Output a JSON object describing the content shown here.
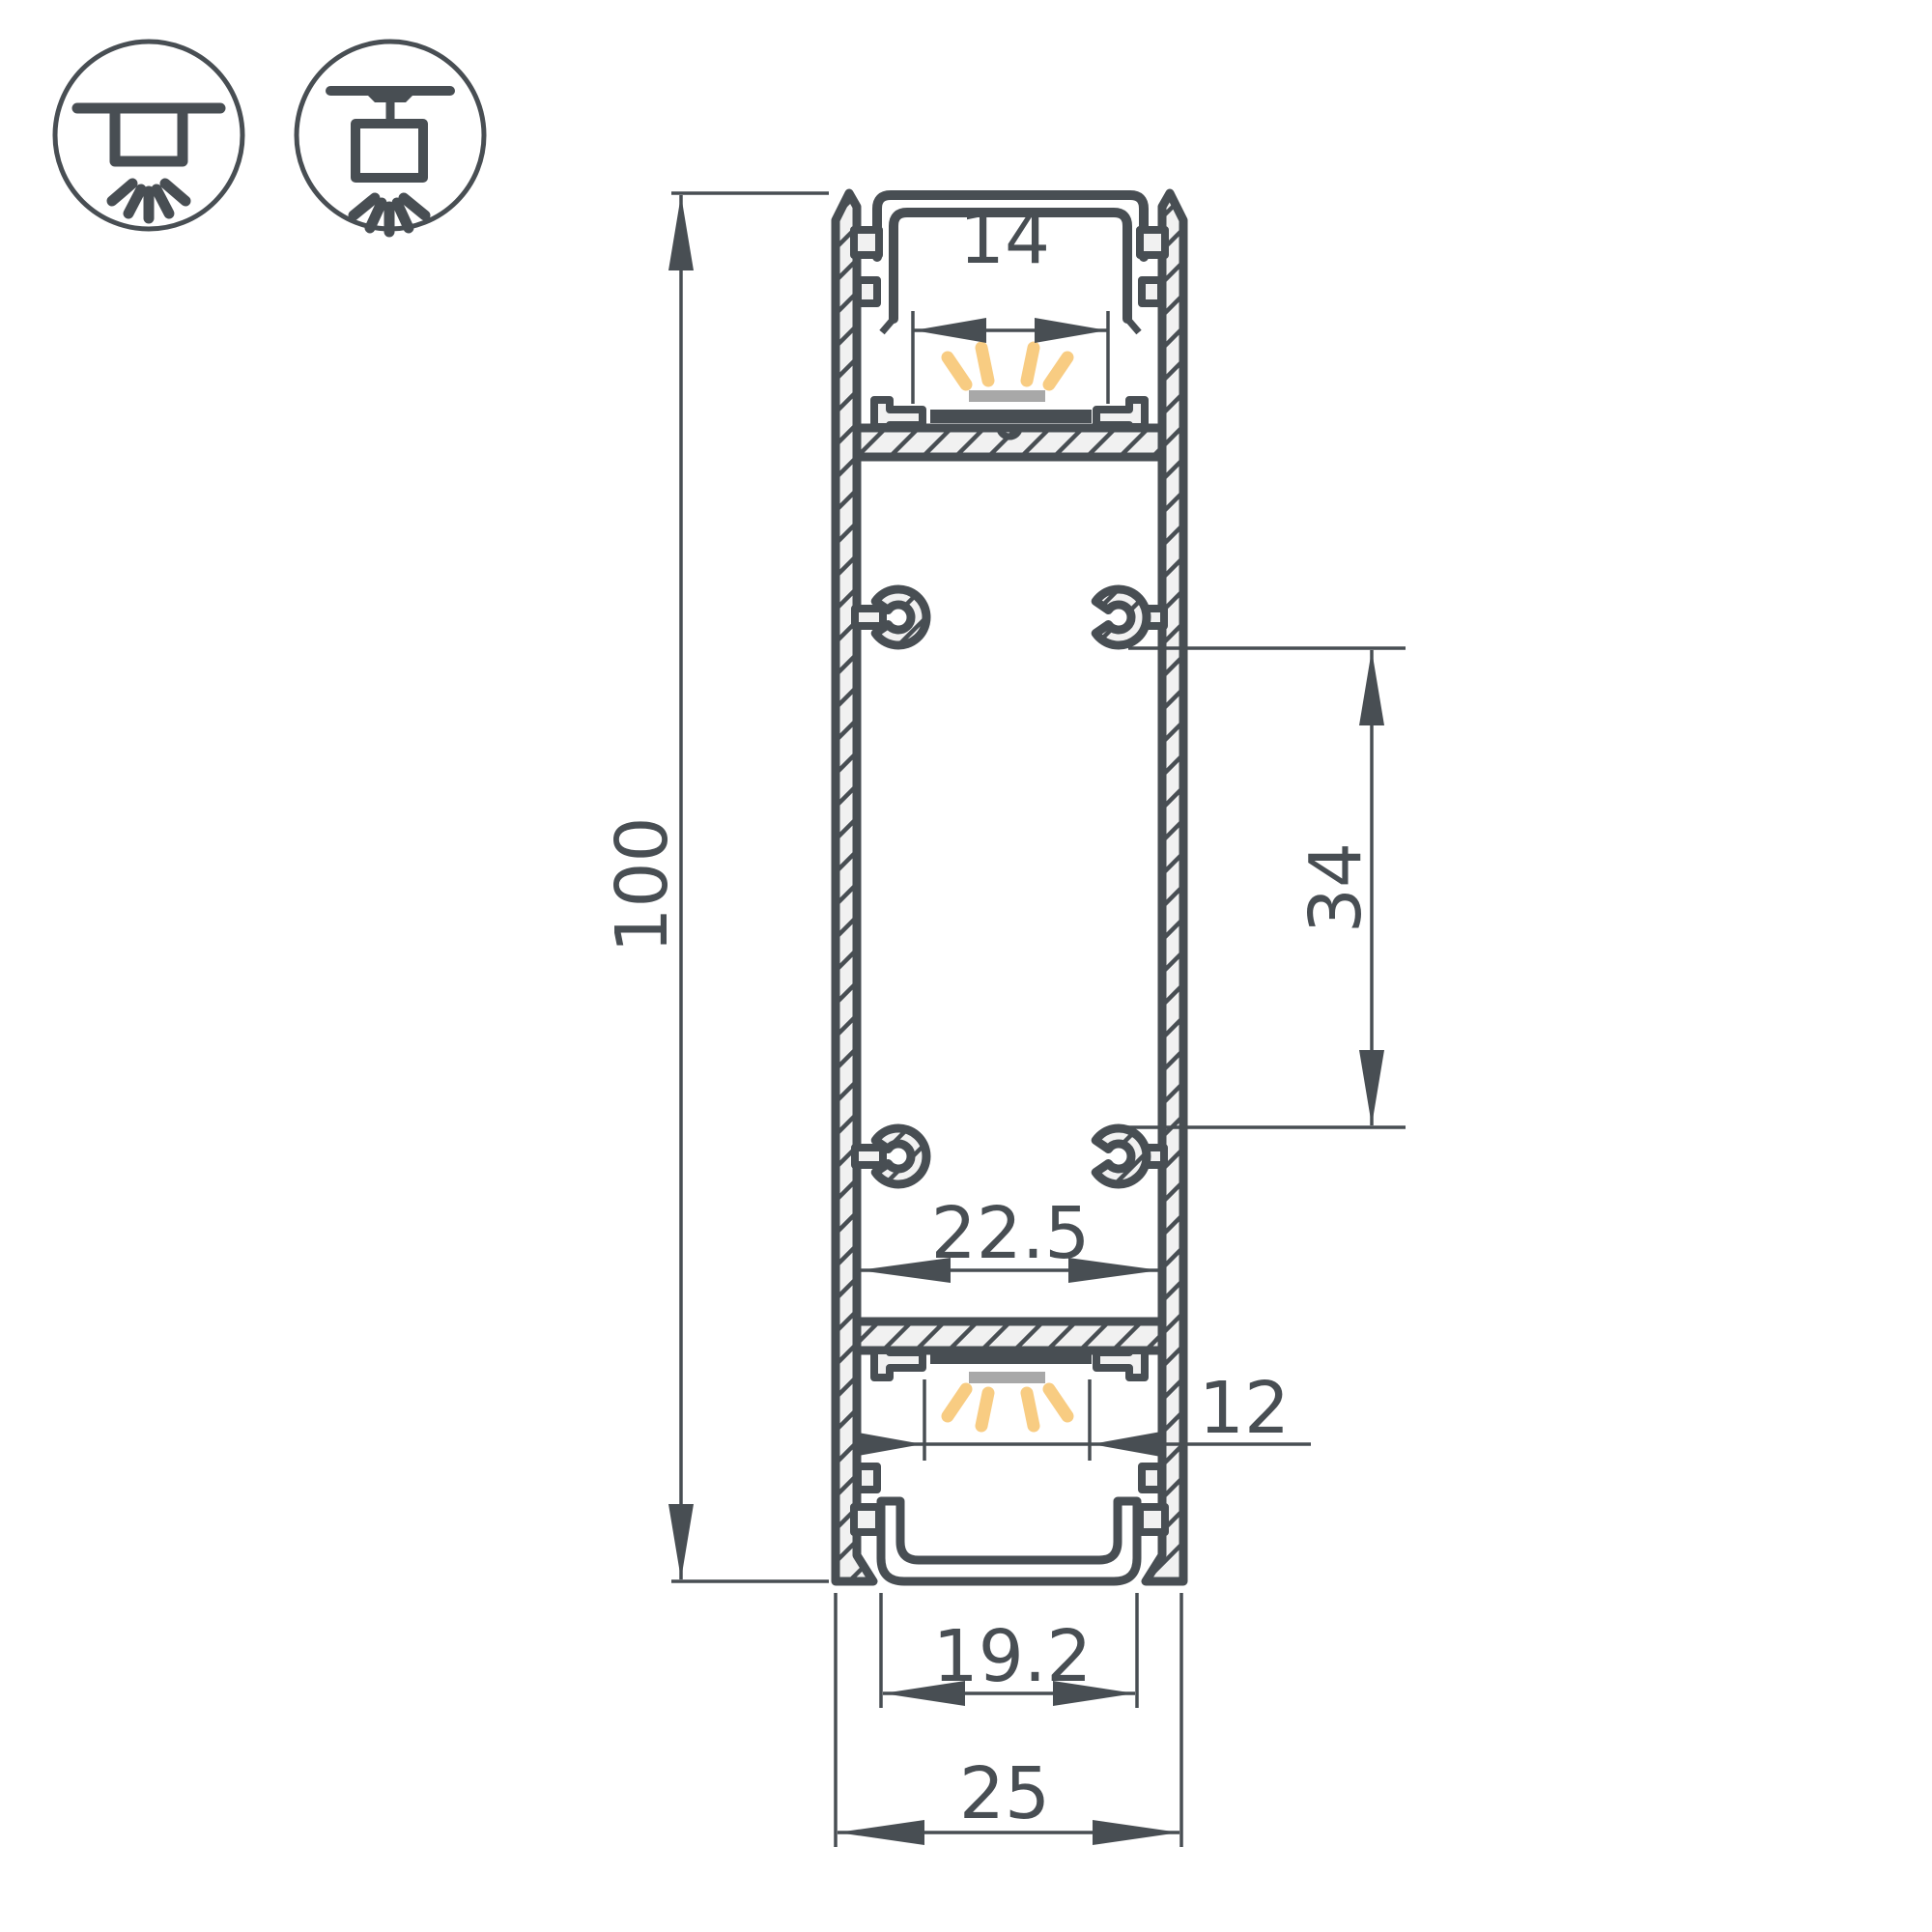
{
  "colors": {
    "line": "#484e53",
    "fill_light": "#f1f1f1",
    "led_pcb": "#484e53",
    "led_emitter": "#a8a8a8",
    "light_rays": "#f8cc82",
    "background": "#ffffff"
  },
  "icons": [
    {
      "name": "ceiling-surface-mount-icon"
    },
    {
      "name": "ceiling-pendant-mount-icon"
    }
  ],
  "dimensions": {
    "overall_height": "100",
    "top_opening_width": "14",
    "screw_boss_spacing": "34",
    "inner_cavity_width": "22.5",
    "bottom_led_window_width": "12",
    "bottom_channel_width": "19.2",
    "overall_width": "25"
  }
}
